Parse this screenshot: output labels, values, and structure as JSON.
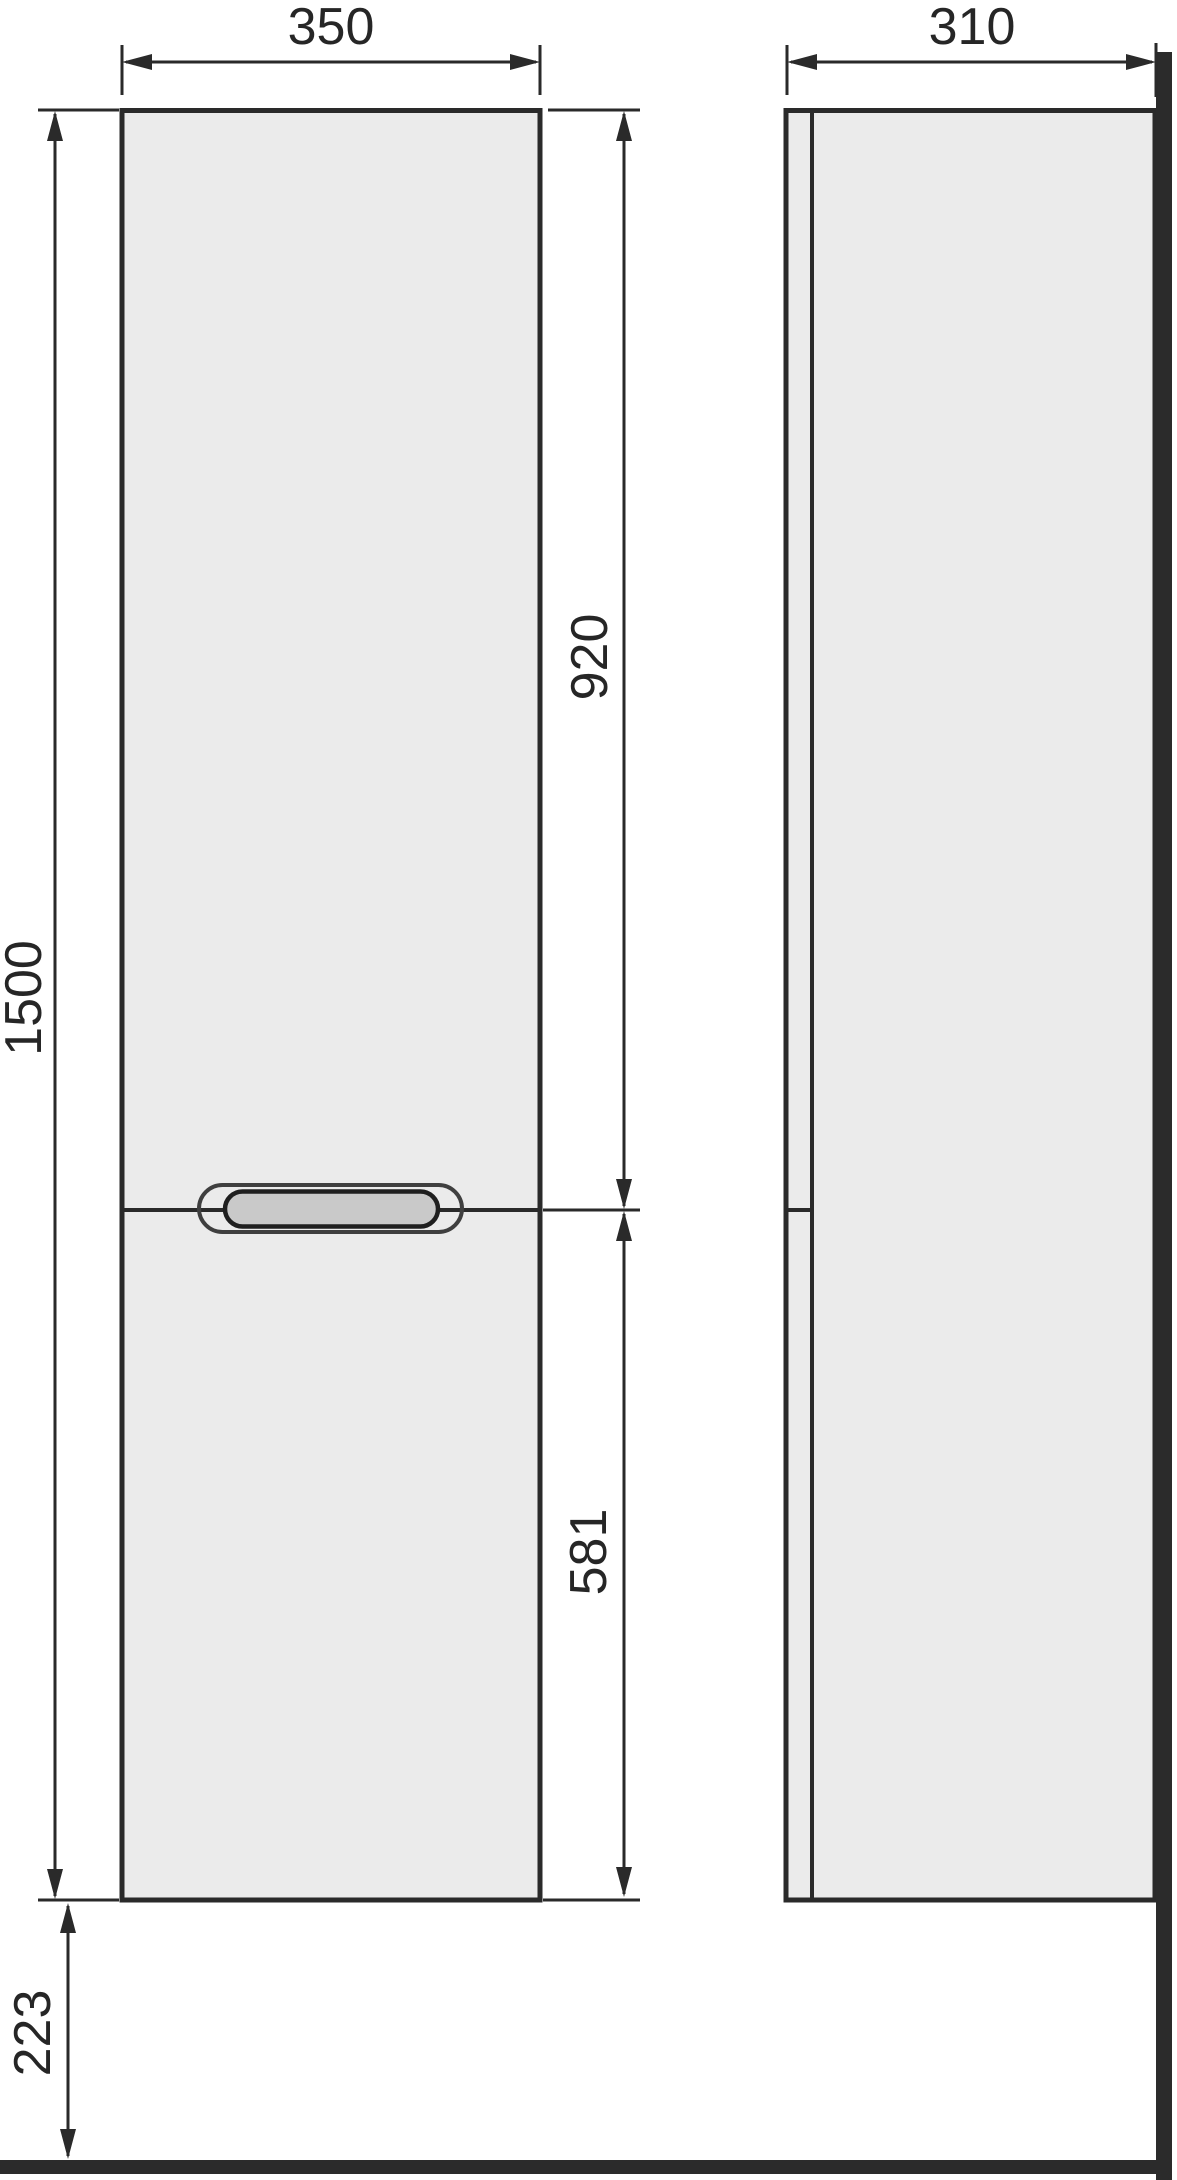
{
  "drawing": {
    "title": "tall-cabinet-dimension-drawing",
    "views": [
      "front",
      "side"
    ],
    "colors": {
      "background": "#ffffff",
      "panel_fill": "#ebebeb",
      "line": "#2a2a2a",
      "wall_floor": "#2b2b2b",
      "handle_fill": "#c9c9c9",
      "handle_ring": "#3f3f3f",
      "text": "#262626"
    }
  },
  "dimensions": {
    "front_width": {
      "value": "350"
    },
    "side_depth": {
      "value": "310"
    },
    "overall_height": {
      "value": "1500"
    },
    "upper_door_height": {
      "value": "920"
    },
    "lower_door_height": {
      "value": "581"
    },
    "floor_clearance": {
      "value": "223"
    }
  }
}
